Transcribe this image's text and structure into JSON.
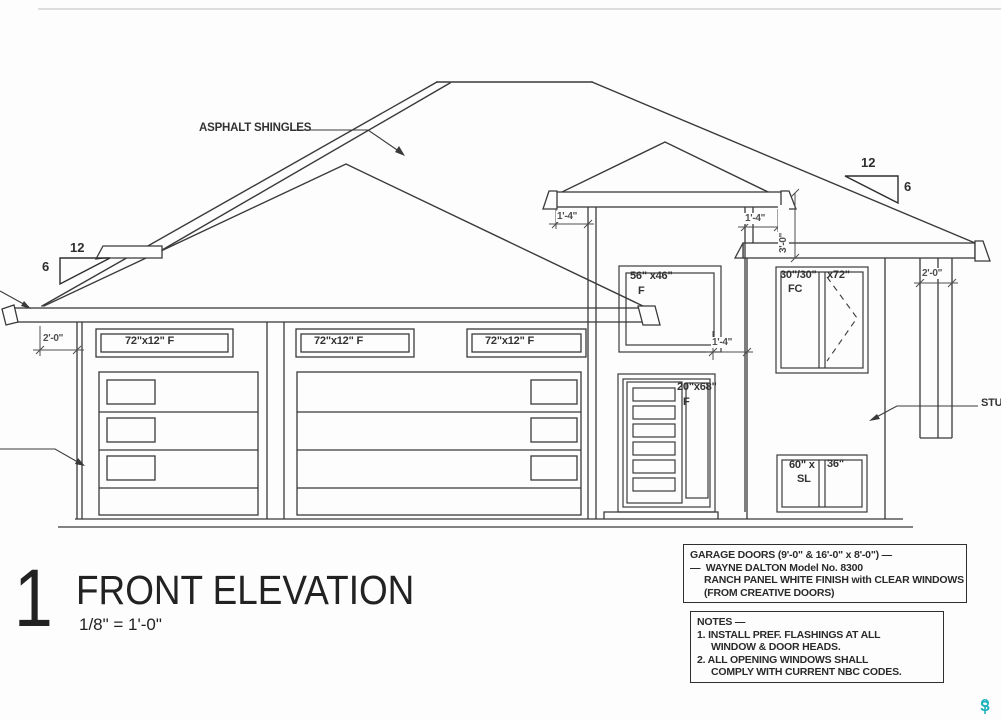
{
  "drawing": {
    "material_label": "ASPHALT SHINGLES",
    "stucco_label": "STU",
    "slope_left": {
      "run": "12",
      "rise": "6"
    },
    "slope_right": {
      "run": "12",
      "rise": "6"
    },
    "windows": {
      "transom1": "72\"x12\" F",
      "transom2": "72\"x12\" F",
      "transom3": "72\"x12\" F",
      "upper": {
        "size": "56\" x46\"",
        "type": "F"
      },
      "casement": {
        "size": "30\"/30\"",
        "type": "FC",
        "height": "x72\""
      },
      "sidelite": {
        "size": "20\"x68\"",
        "type": "F"
      },
      "slider": {
        "size_a": "60\" x",
        "type": "SL",
        "size_b": "36\""
      }
    },
    "dimensions": {
      "left_overhang": "2'-0\"",
      "right_overhang": "2'-0\"",
      "tower_left": "1'-4\"",
      "tower_right": "1'-4\"",
      "wall_jog": "1'-4\"",
      "fascia_drop": "3'-0\""
    }
  },
  "title_block": {
    "sheet_number": "1",
    "title": "FRONT ELEVATION",
    "scale": "1/8\" = 1'-0\""
  },
  "garage_note": {
    "line1": "GARAGE DOORS (9'-0\" & 16'-0\" x 8'-0\") —",
    "line2": "—  WAYNE DALTON Model No. 8300",
    "line3": "RANCH PANEL WHITE FINISH with CLEAR WINDOWS",
    "line4": "(FROM CREATIVE DOORS)"
  },
  "general_notes": {
    "line1": "NOTES —",
    "line2": "1. INSTALL PREF. FLASHINGS AT ALL",
    "line3": "WINDOW & DOOR HEADS.",
    "line4": "2. ALL OPENING WINDOWS SHALL",
    "line5": "COMPLY WITH CURRENT NBC CODES."
  },
  "watermark": {
    "text": "S"
  }
}
